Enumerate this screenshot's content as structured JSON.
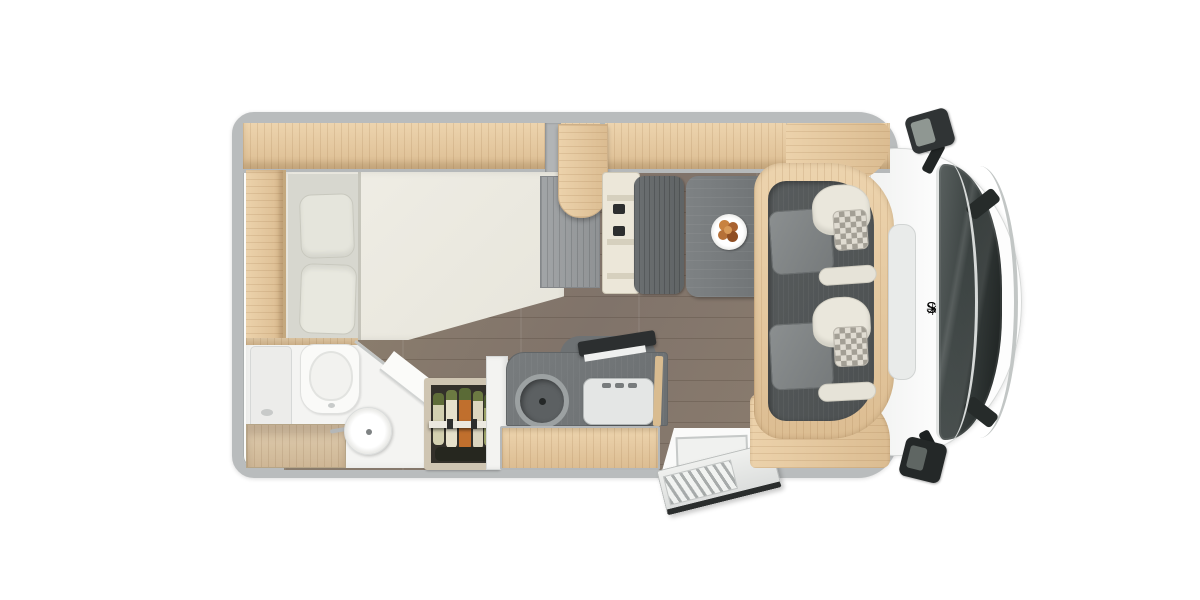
{
  "scene": {
    "description": "Top-down rendered floor plan of a Sunlight motorhome with front cab",
    "view": "top-down"
  },
  "brand": {
    "label": "Sunlight",
    "logo_glyph": "✳",
    "logo_icon": "sun-icon",
    "text_color": "#3b3e40"
  },
  "colors": {
    "background": "#ffffff",
    "body_wall_gray": "#b9bcbd",
    "cab_body_white": "#fbfcfc",
    "furniture_wood": "#e2c79e",
    "floor_wood": "#87796b",
    "kitchen_counter": "#74787a",
    "cab_mat": "#54585a",
    "seat_gray": "#85898a",
    "seat_cream": "#eae7dc",
    "table_gray": "#7b7f81",
    "wardrobe_gray": "#9b9ea0",
    "windshield_glass": "#343a3a",
    "mirror_black": "#2b2f2f",
    "carrot_orange": "#c06f2d",
    "greens": "#5f6d38",
    "plate_food": "#c8823f"
  },
  "features": [
    "overhead-lockers",
    "wall-window",
    "wall-window",
    "wall-window",
    "french-bed",
    "pillows",
    "wardrobe",
    "dinette-bench-with-seatbelts",
    "dinette-table",
    "plate-with-food",
    "cab-swivel-seats",
    "dashboard",
    "windshield-with-wipers",
    "front-grille",
    "side-mirror",
    "side-mirror",
    "wood-floor",
    "kitchen-round-sink",
    "gas-hob-3-burners",
    "hob-lid-open",
    "pantry-with-vegetables",
    "fridge-tower",
    "toilet",
    "round-washbasin",
    "vanity-counter",
    "shower-tray",
    "entry-door-open",
    "entry-step"
  ]
}
